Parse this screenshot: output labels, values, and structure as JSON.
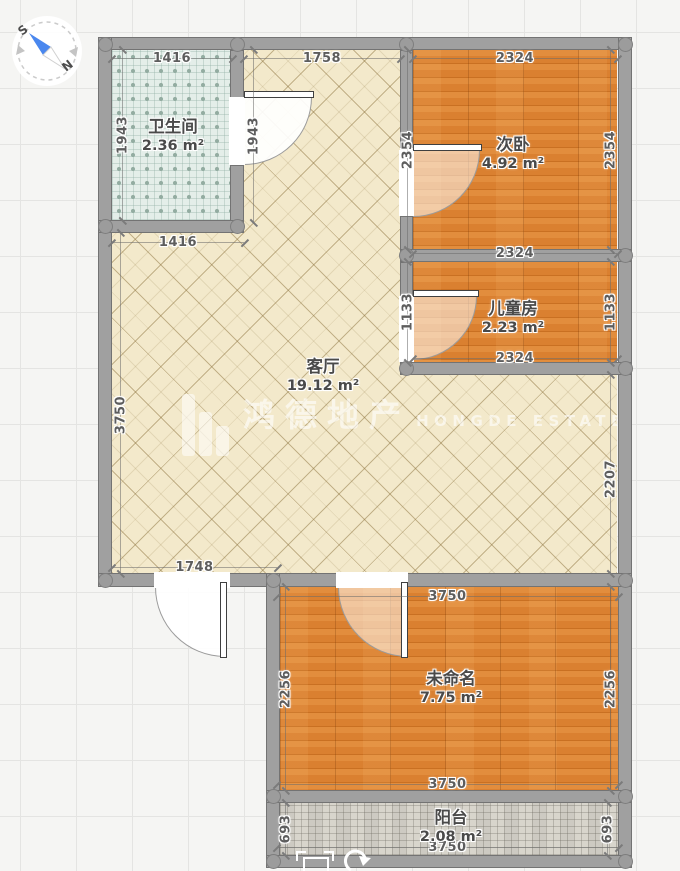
{
  "compass": {
    "south_label": "S",
    "north_label": "N",
    "needle_color": "#4a87ee"
  },
  "watermark": {
    "cn": "鸿德地产",
    "en": "HONGDE ESTATE"
  },
  "plan": {
    "wall_color": "#a0a0a0",
    "rooms": [
      {
        "id": "bathroom",
        "name": "卫生间",
        "area": "2.36 m²",
        "floor": "tile-teal",
        "rect": [
          112,
          50,
          118,
          170
        ],
        "label": [
          173,
          117
        ]
      },
      {
        "id": "living",
        "name": "客厅",
        "area": "19.12 m²",
        "floor": "ceramic",
        "rect": [
          112,
          50,
          505,
          523
        ],
        "label": [
          323,
          357
        ],
        "clip": "polygon(132px 0px, 288px 0px, 288px 325px, 505px 325px, 505px 523px, 0px 523px, 0px 183px, 132px 183px)"
      },
      {
        "id": "bedroom2",
        "name": "次卧",
        "area": "4.92 m²",
        "floor": "wood",
        "rect": [
          413,
          50,
          204,
          199
        ],
        "label": [
          513,
          135
        ]
      },
      {
        "id": "kids",
        "name": "儿童房",
        "area": "2.23 m²",
        "floor": "wood",
        "rect": [
          413,
          262,
          204,
          100
        ],
        "label": [
          513,
          299
        ]
      },
      {
        "id": "unnamed",
        "name": "未命名",
        "area": "7.75 m²",
        "floor": "wood",
        "rect": [
          280,
          587,
          338,
          203
        ],
        "label": [
          451,
          669
        ]
      },
      {
        "id": "balcony",
        "name": "阳台",
        "area": "2.08 m²",
        "floor": "tile-gray",
        "rect": [
          280,
          803,
          338,
          52
        ],
        "label": [
          451,
          808
        ]
      }
    ],
    "walls": [
      [
        98,
        37,
        534,
        13
      ],
      [
        98,
        37,
        14,
        550
      ],
      [
        618,
        37,
        14,
        825
      ],
      [
        230,
        50,
        14,
        48
      ],
      [
        230,
        165,
        14,
        68
      ],
      [
        98,
        220,
        146,
        13
      ],
      [
        400,
        50,
        13,
        98
      ],
      [
        400,
        216,
        13,
        46
      ],
      [
        400,
        249,
        232,
        13
      ],
      [
        400,
        262,
        13,
        34
      ],
      [
        400,
        362,
        232,
        13
      ],
      [
        98,
        573,
        534,
        14
      ],
      [
        266,
        573,
        14,
        289
      ],
      [
        266,
        790,
        366,
        13
      ],
      [
        266,
        855,
        366,
        13
      ]
    ],
    "dots": [
      [
        105,
        44
      ],
      [
        237,
        44
      ],
      [
        406,
        44
      ],
      [
        625,
        44
      ],
      [
        105,
        226
      ],
      [
        237,
        226
      ],
      [
        406,
        255
      ],
      [
        625,
        255
      ],
      [
        406,
        368
      ],
      [
        625,
        368
      ],
      [
        105,
        580
      ],
      [
        273,
        580
      ],
      [
        625,
        580
      ],
      [
        273,
        796
      ],
      [
        625,
        796
      ],
      [
        273,
        861
      ],
      [
        625,
        861
      ]
    ],
    "doors": [
      {
        "id": "bathroom-door",
        "gap": [
          229,
          97,
          16,
          68
        ],
        "disc": [
          244,
          97,
          68,
          "br"
        ],
        "opacity": 0.92,
        "leaf": [
          244,
          91,
          70,
          7
        ]
      },
      {
        "id": "bedroom2-door",
        "gap": [
          399,
          150,
          15,
          66
        ],
        "disc": [
          413,
          150,
          67,
          "br"
        ],
        "opacity": 0.52,
        "leaf": [
          413,
          144,
          69,
          7
        ]
      },
      {
        "id": "kids-door",
        "gap": [
          399,
          296,
          15,
          66
        ],
        "disc": [
          413,
          296,
          64,
          "br"
        ],
        "opacity": 0.52,
        "leaf": [
          413,
          290,
          66,
          7
        ]
      },
      {
        "id": "unnamed-door",
        "gap": [
          336,
          572,
          72,
          16
        ],
        "disc": [
          338,
          587,
          70,
          "bl"
        ],
        "opacity": 0.5,
        "leaf": [
          401,
          582,
          7,
          76
        ]
      },
      {
        "id": "entrance-door",
        "gap": [
          154,
          572,
          76,
          16
        ],
        "disc": [
          155,
          587,
          70,
          "bl"
        ],
        "opacity": 0.93,
        "leaf": [
          220,
          582,
          7,
          76
        ]
      }
    ],
    "dims": [
      {
        "label": "1416",
        "orient": "h",
        "x": 112,
        "y": 58,
        "len": 120
      },
      {
        "label": "1758",
        "orient": "h",
        "x": 244,
        "y": 58,
        "len": 156
      },
      {
        "label": "2324",
        "orient": "h",
        "x": 413,
        "y": 58,
        "len": 204
      },
      {
        "label": "1943",
        "orient": "v",
        "x": 122,
        "y": 50,
        "len": 170
      },
      {
        "label": "1943",
        "orient": "v",
        "x": 253,
        "y": 50,
        "len": 172
      },
      {
        "label": "2354",
        "orient": "v",
        "x": 407,
        "y": 50,
        "len": 199
      },
      {
        "label": "2354",
        "orient": "v",
        "x": 610,
        "y": 50,
        "len": 199
      },
      {
        "label": "1416",
        "orient": "h",
        "x": 112,
        "y": 242,
        "len": 132
      },
      {
        "label": "2324",
        "orient": "h",
        "x": 413,
        "y": 253,
        "len": 204
      },
      {
        "label": "1133",
        "orient": "v",
        "x": 407,
        "y": 262,
        "len": 100
      },
      {
        "label": "1133",
        "orient": "v",
        "x": 610,
        "y": 262,
        "len": 100
      },
      {
        "label": "2324",
        "orient": "h",
        "x": 413,
        "y": 358,
        "len": 204
      },
      {
        "label": "3750",
        "orient": "v",
        "x": 120,
        "y": 233,
        "len": 340,
        "t": 182
      },
      {
        "label": "2207",
        "orient": "v",
        "x": 610,
        "y": 375,
        "len": 198,
        "t": 104
      },
      {
        "label": "1748",
        "orient": "h",
        "x": 112,
        "y": 567,
        "len": 165
      },
      {
        "label": "3750",
        "orient": "h",
        "x": 277,
        "y": 596,
        "len": 341
      },
      {
        "label": "2256",
        "orient": "v",
        "x": 285,
        "y": 587,
        "len": 203
      },
      {
        "label": "2256",
        "orient": "v",
        "x": 610,
        "y": 587,
        "len": 203
      },
      {
        "label": "3750",
        "orient": "h",
        "x": 277,
        "y": 784,
        "len": 341
      },
      {
        "label": "693",
        "orient": "v",
        "x": 285,
        "y": 803,
        "len": 52
      },
      {
        "label": "693",
        "orient": "v",
        "x": 607,
        "y": 803,
        "len": 52
      },
      {
        "label": "3750",
        "orient": "h",
        "x": 277,
        "y": 847,
        "len": 341
      }
    ]
  },
  "handles": {
    "select_icon": "selection-square-icon",
    "rotate_icon": "rotate-arrow-icon"
  }
}
